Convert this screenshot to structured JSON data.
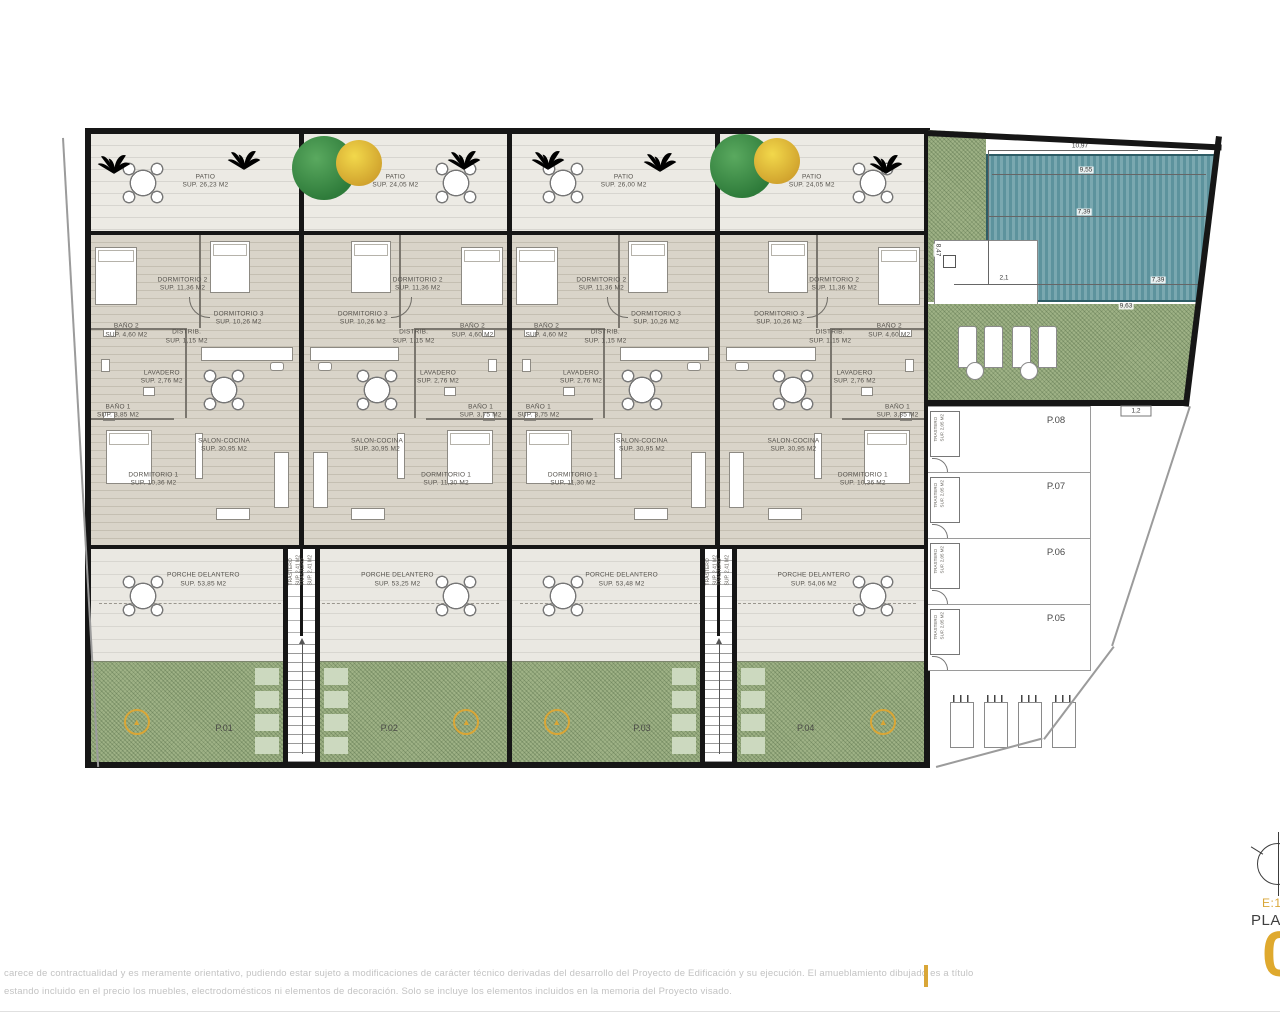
{
  "units": [
    {
      "id": "P.01",
      "patio": {
        "name": "PATIO",
        "area": "SUP. 26,23 M2"
      },
      "porche": {
        "name": "PORCHE DELANTERO",
        "area": "SUP. 53,85 M2"
      },
      "rooms": {
        "d2": {
          "n": "DORMITORIO 2",
          "a": "SUP. 11,36 M2"
        },
        "d3": {
          "n": "DORMITORIO 3",
          "a": "SUP. 10,26 M2"
        },
        "b2": {
          "n": "BAÑO 2",
          "a": "SUP. 4,60 M2"
        },
        "di": {
          "n": "DISTRIB.",
          "a": "SUP. 1,15 M2"
        },
        "lv": {
          "n": "LAVADERO",
          "a": "SUP. 2,76 M2"
        },
        "b1": {
          "n": "BAÑO 1",
          "a": "SUP. 3,85 M2"
        },
        "d1": {
          "n": "DORMITORIO 1",
          "a": "SUP. 10,36 M2"
        },
        "sc": {
          "n": "SALON-COCINA",
          "a": "SUP. 30,95 M2"
        }
      }
    },
    {
      "id": "P.02",
      "patio": {
        "name": "PATIO",
        "area": "SUP. 24,05 M2"
      },
      "porche": {
        "name": "PORCHE DELANTERO",
        "area": "SUP. 53,25 M2"
      },
      "rooms": {
        "d2": {
          "n": "DORMITORIO 2",
          "a": "SUP. 11,36 M2"
        },
        "d3": {
          "n": "DORMITORIO 3",
          "a": "SUP. 10,26 M2"
        },
        "b2": {
          "n": "BAÑO 2",
          "a": "SUP. 4,60 M2"
        },
        "di": {
          "n": "DISTRIB.",
          "a": "SUP. 1,15 M2"
        },
        "lv": {
          "n": "LAVADERO",
          "a": "SUP. 2,76 M2"
        },
        "b1": {
          "n": "BAÑO 1",
          "a": "SUP. 3,75 M2"
        },
        "d1": {
          "n": "DORMITORIO 1",
          "a": "SUP. 11,30 M2"
        },
        "sc": {
          "n": "SALON-COCINA",
          "a": "SUP. 30,95 M2"
        }
      }
    },
    {
      "id": "P.03",
      "patio": {
        "name": "PATIO",
        "area": "SUP. 26,00 M2"
      },
      "porche": {
        "name": "PORCHE DELANTERO",
        "area": "SUP. 53,48 M2"
      },
      "rooms": {
        "d2": {
          "n": "DORMITORIO 2",
          "a": "SUP. 11,36 M2"
        },
        "d3": {
          "n": "DORMITORIO 3",
          "a": "SUP. 10,26 M2"
        },
        "b2": {
          "n": "BAÑO 2",
          "a": "SUP. 4,60 M2"
        },
        "di": {
          "n": "DISTRIB.",
          "a": "SUP. 1,15 M2"
        },
        "lv": {
          "n": "LAVADERO",
          "a": "SUP. 2,76 M2"
        },
        "b1": {
          "n": "BAÑO 1",
          "a": "SUP. 3,75 M2"
        },
        "d1": {
          "n": "DORMITORIO 1",
          "a": "SUP. 11,30 M2"
        },
        "sc": {
          "n": "SALON-COCINA",
          "a": "SUP. 30,95 M2"
        }
      }
    },
    {
      "id": "P.04",
      "patio": {
        "name": "PATIO",
        "area": "SUP. 24,05 M2"
      },
      "porche": {
        "name": "PORCHE DELANTERO",
        "area": "SUP. 54,06 M2"
      },
      "rooms": {
        "d2": {
          "n": "DORMITORIO 2",
          "a": "SUP. 11,36 M2"
        },
        "d3": {
          "n": "DORMITORIO 3",
          "a": "SUP. 10,26 M2"
        },
        "b2": {
          "n": "BAÑO 2",
          "a": "SUP. 4,60 M2"
        },
        "di": {
          "n": "DISTRIB.",
          "a": "SUP. 1,15 M2"
        },
        "lv": {
          "n": "LAVADERO",
          "a": "SUP. 2,76 M2"
        },
        "b1": {
          "n": "BAÑO 1",
          "a": "SUP. 3,85 M2"
        },
        "d1": {
          "n": "DORMITORIO 1",
          "a": "SUP. 10,36 M2"
        },
        "sc": {
          "n": "SALON-COCINA",
          "a": "SUP. 30,95 M2"
        }
      }
    }
  ],
  "core": {
    "name": "TRASTERO",
    "area": "SUP. 2,41 M2"
  },
  "parking": {
    "stalls": [
      {
        "id": "P.08"
      },
      {
        "id": "P.07"
      },
      {
        "id": "P.06"
      },
      {
        "id": "P.05"
      }
    ],
    "trastero_name": "TRASTERO",
    "trastero_area": "SUP. 2,05 M2"
  },
  "pool": {
    "d_top": "10,97",
    "d_upper": "9,55",
    "d_mid": "7,39",
    "d_left": "2,1",
    "d_lower": "7,39",
    "d_bottom": "9,63",
    "d_side": "8,47",
    "d_gap": "1,2"
  },
  "footer": {
    "line1": "carece de contractualidad y es meramente orientativo, pudiendo estar sujeto a modificaciones de carácter técnico derivadas del desarrollo del Proyecto de Edificación y su ejecución. El amueblamiento dibujado es a título",
    "line2": "estando incluido en el precio los muebles, electrodomésticos ni elementos de decoración. Solo se incluye los elementos incluidos en la memoria del Proyecto visado."
  },
  "logo": {
    "scale": "E:1",
    "plan": "PLAN",
    "number": "0"
  },
  "colors": {
    "accent_gold": "#d9a637",
    "garden_green": "#9fb286",
    "pool_teal": "#6fa3ac",
    "wall_black": "#161616"
  }
}
